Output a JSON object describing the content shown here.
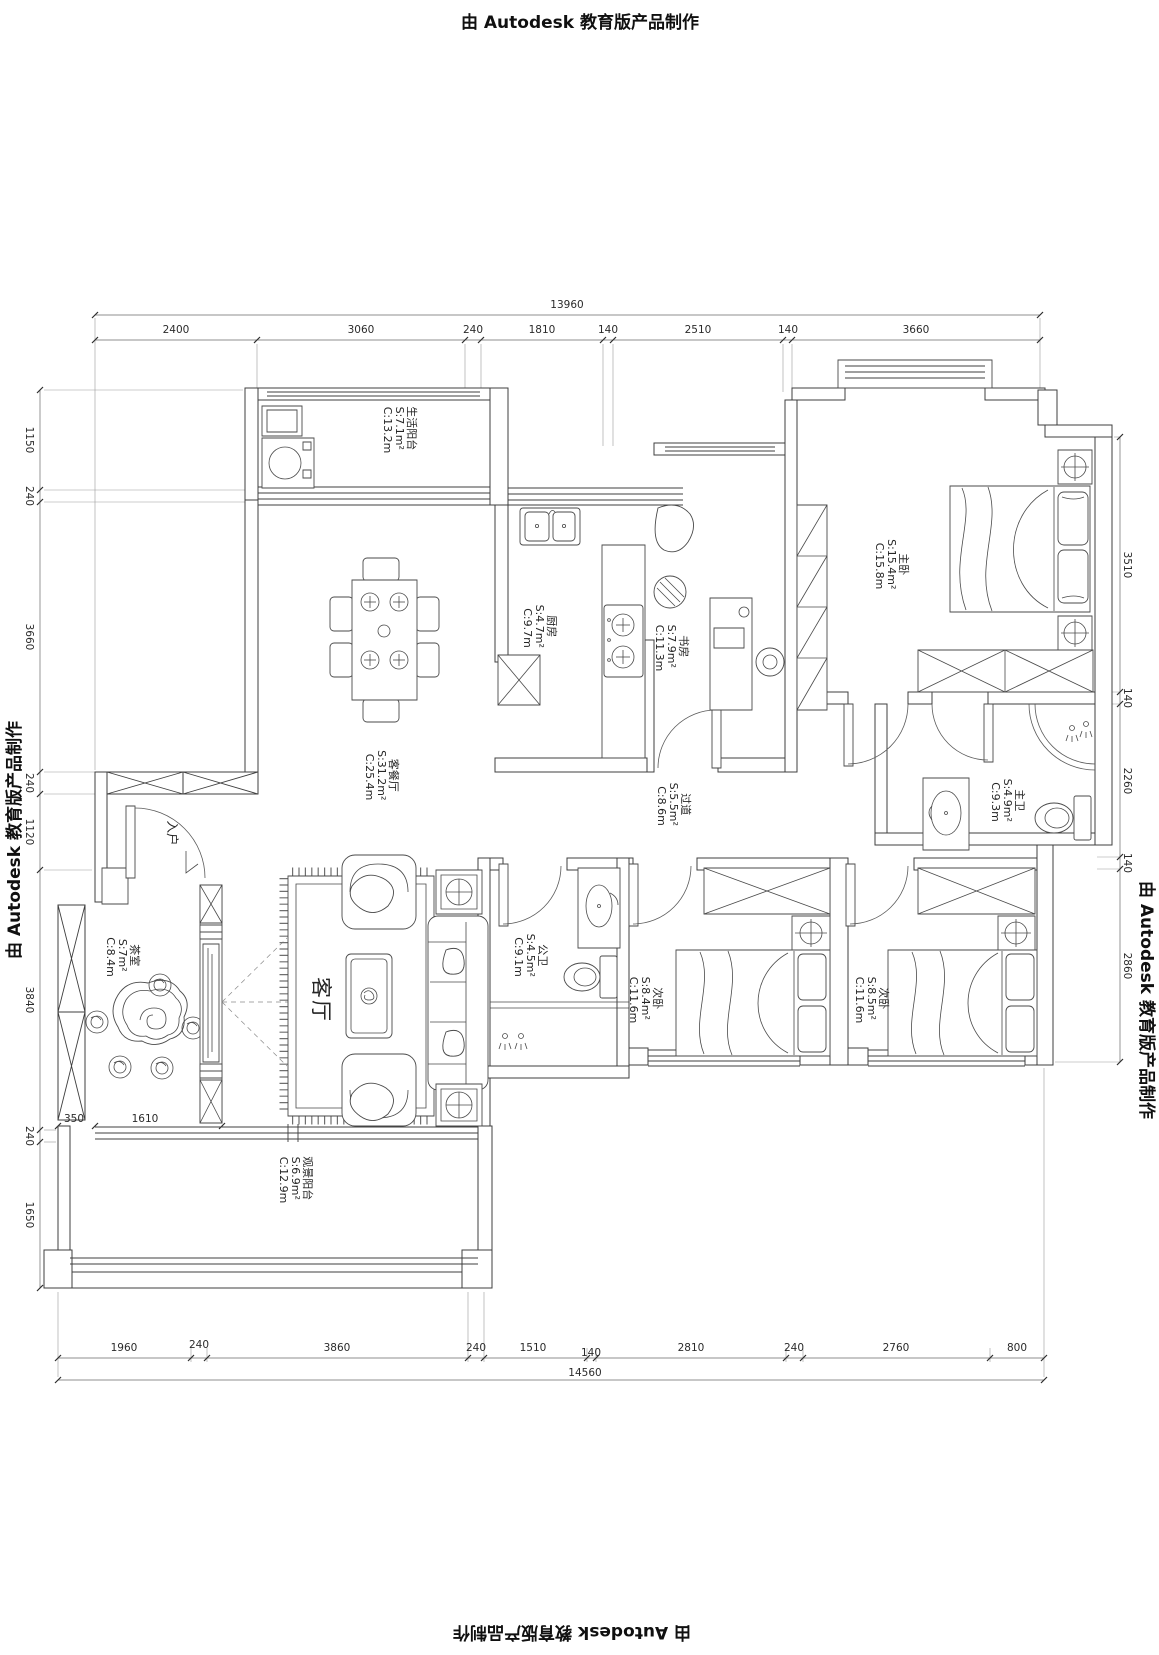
{
  "watermark": {
    "text": "由 Autodesk 教育版产品制作"
  },
  "rooms": {
    "service_balcony": {
      "name": "生活阳台",
      "s": "S:7.1m²",
      "c": "C:13.2m"
    },
    "kitchen": {
      "name": "厨房",
      "s": "S:4.7m²",
      "c": "C:9.7m"
    },
    "study": {
      "name": "书房",
      "s": "S:7.9m²",
      "c": "C:11.3m"
    },
    "master_bedroom": {
      "name": "主卧",
      "s": "S:15.4m²",
      "c": "C:15.8m"
    },
    "living_dining": {
      "name": "客餐厅",
      "s": "S:31.2m²",
      "c": "C:25.4m"
    },
    "corridor": {
      "name": "过道",
      "s": "S:5.5m²",
      "c": "C:8.6m"
    },
    "master_bath": {
      "name": "主卫",
      "s": "S:4.9m²",
      "c": "C:9.3m"
    },
    "tea_room": {
      "name": "茶室",
      "s": "S:7m²",
      "c": "C:8.4m"
    },
    "living_room": {
      "name": "客厅"
    },
    "guest_bath": {
      "name": "公卫",
      "s": "S:4.5m²",
      "c": "C:9.1m"
    },
    "bedroom_2": {
      "name": "次卧",
      "s": "S:8.4m²",
      "c": "C:11.6m"
    },
    "bedroom_3": {
      "name": "次卧",
      "s": "S:8.5m²",
      "c": "C:11.6m"
    },
    "view_balcony": {
      "name": "观景阳台",
      "s": "S:6.9m²",
      "c": "C:12.9m"
    },
    "entry": {
      "name": "入户"
    }
  },
  "dimensions": {
    "top": {
      "total": "13960",
      "segments": [
        "2400",
        "3060",
        "240",
        "1810",
        "140",
        "2510",
        "140",
        "3660"
      ]
    },
    "bottom": {
      "total": "14560",
      "segments": [
        "1960",
        "240",
        "3860",
        "240",
        "1510",
        "140",
        "2810",
        "240",
        "2760",
        "800"
      ]
    },
    "left": {
      "segments": [
        "1150",
        "240",
        "3660",
        "240",
        "1120",
        "3840",
        "240",
        "1650"
      ]
    },
    "right": {
      "segments": [
        "3510",
        "140",
        "2260",
        "140",
        "2860"
      ]
    },
    "interior": {
      "a": "350",
      "b": "1610"
    }
  }
}
